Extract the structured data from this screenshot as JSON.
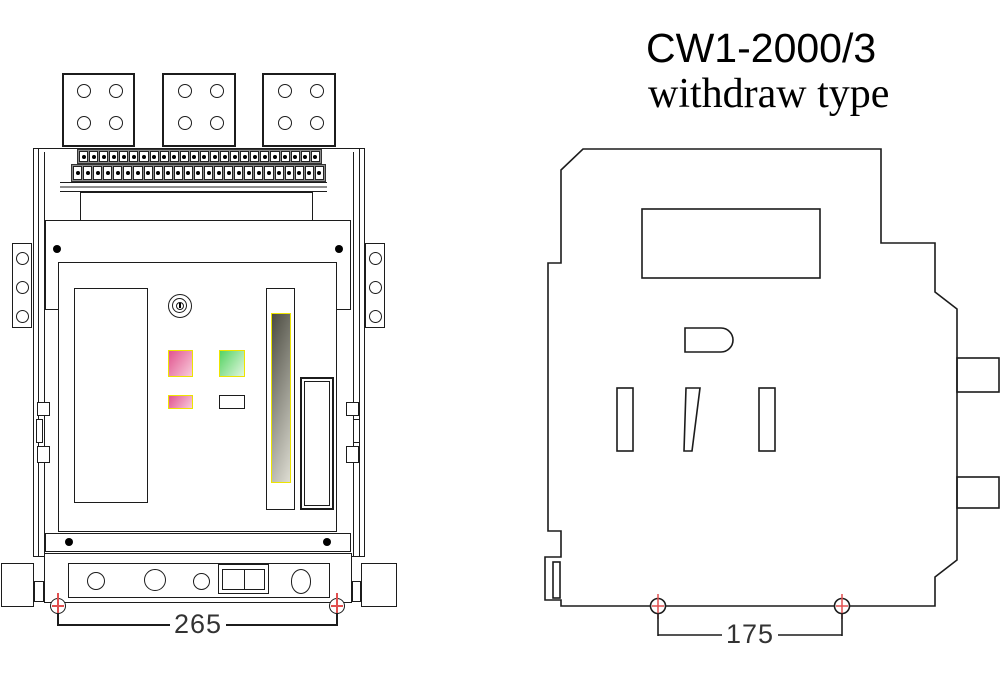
{
  "title": {
    "model": "CW1-2000/3",
    "type_label": "withdraw type"
  },
  "front_view": {
    "dimension_mm": "265",
    "terminal_rows": [
      {
        "count": 24
      },
      {
        "count": 25
      }
    ],
    "terminal_pads": 3,
    "holes_per_pad": 4,
    "bracket_holes_per_side": 3
  },
  "side_view": {
    "dimension_mm": "175"
  },
  "colors": {
    "line": "#1c1c1c",
    "highlight_yellow": "#ede400",
    "pink_dark": "#e1548f",
    "pink_light": "#f8cbdb",
    "green_dark": "#55d363",
    "green_light": "#e2f6e0",
    "slot_dark": "#4b4b41",
    "slot_light": "#deddd3",
    "anchor_red": "#e04f4f",
    "dim_text": "#333333"
  }
}
